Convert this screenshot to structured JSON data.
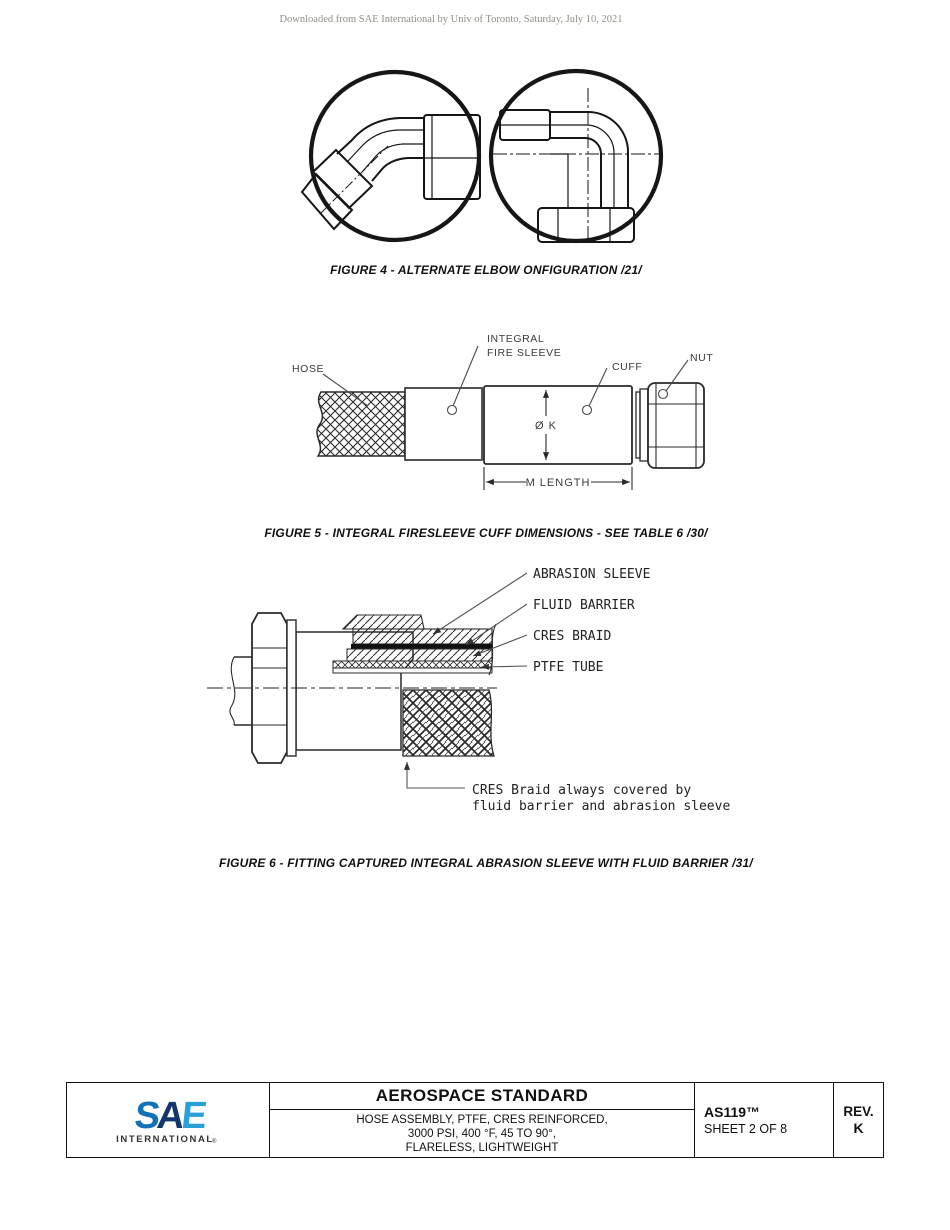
{
  "page": {
    "watermark": "Downloaded from SAE International by Univ of Toronto, Saturday, July 10, 2021"
  },
  "figures": {
    "figure4": {
      "caption": "FIGURE 4 - ALTERNATE ELBOW ONFIGURATION /21/"
    },
    "figure5": {
      "caption": "FIGURE 5 - INTEGRAL FIRESLEEVE CUFF DIMENSIONS - SEE TABLE 6 /30/",
      "labels": {
        "hose": "HOSE",
        "integral1": "INTEGRAL",
        "integral2": "FIRE SLEEVE",
        "cuff": "CUFF",
        "nut": "NUT",
        "dia": "Ø K",
        "length": "M LENGTH"
      }
    },
    "figure6": {
      "caption": "FIGURE 6 - FITTING CAPTURED INTEGRAL ABRASION SLEEVE WITH FLUID BARRIER  /31/",
      "labels": {
        "abrasion": "ABRASION SLEEVE",
        "fluid": "FLUID BARRIER",
        "cres": "CRES BRAID",
        "ptfe": "PTFE TUBE",
        "note1": "CRES Braid always covered by",
        "note2": "fluid barrier and abrasion sleeve"
      }
    }
  },
  "title_block": {
    "logo": {
      "letter_s": "S",
      "letter_a": "A",
      "letter_e": "E",
      "subtitle": "INTERNATIONAL",
      "registered": "®"
    },
    "heading": "AEROSPACE STANDARD",
    "subtitle_line1": "HOSE ASSEMBLY, PTFE, CRES REINFORCED,",
    "subtitle_line2": "3000 PSI, 400 °F, 45 TO 90°,",
    "subtitle_line3": "FLARELESS, LIGHTWEIGHT",
    "document_number": "AS119™",
    "sheet_info": "SHEET 2 OF 8",
    "revision_label": "REV.",
    "revision_value": "K"
  },
  "colors": {
    "ink": "#1f1f1f",
    "watermark_text": "#8f8f87",
    "sae_s": "#1272b8",
    "sae_a": "#15356d",
    "sae_e": "#2aa0d8",
    "sae_wordmark": "#15356d"
  }
}
